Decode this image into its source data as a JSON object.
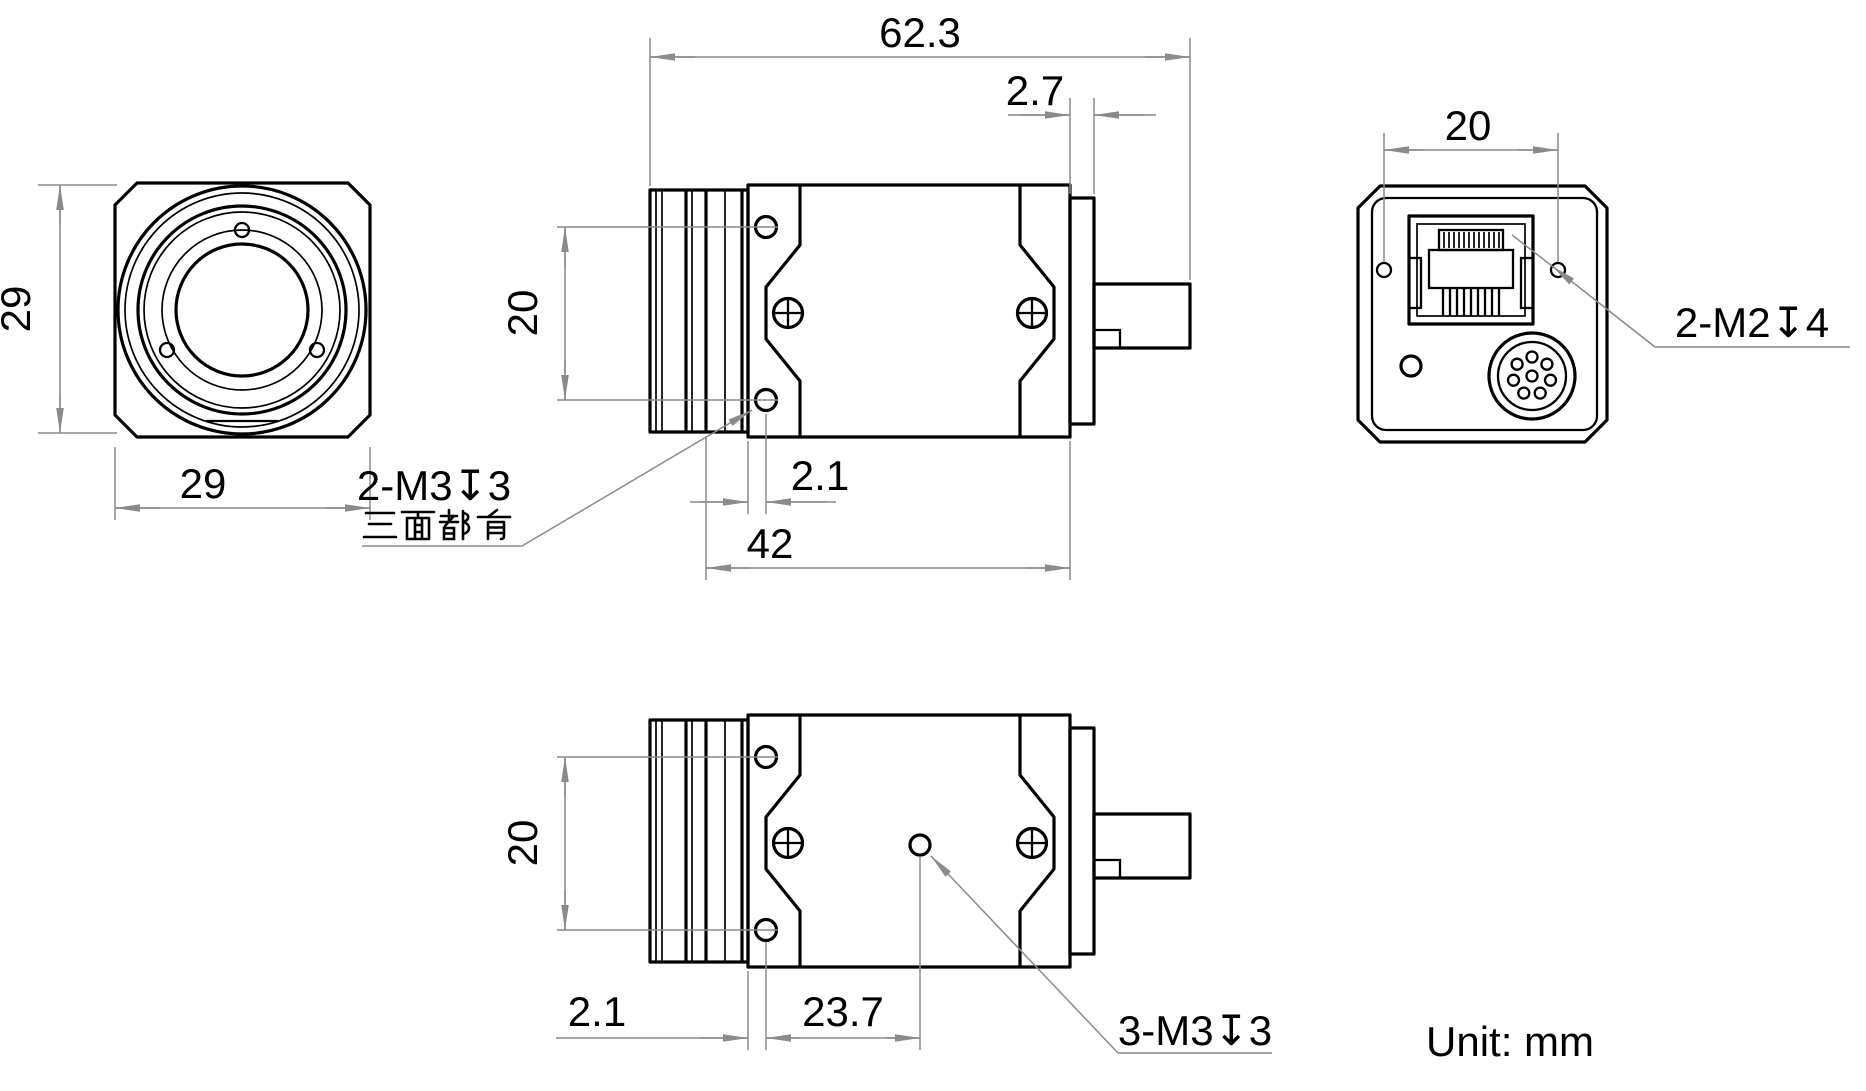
{
  "dims": {
    "front_width": "29",
    "front_height": "29",
    "total_length": "62.3",
    "rear_step": "2.7",
    "side_hole_spacing": "20",
    "side_hole_offset": "2.1",
    "body_length": "42",
    "back_hole_spacing": "20",
    "bottom_hole_spacing": "20",
    "bottom_hole_offset": "2.1",
    "bottom_center_offset": "23.7"
  },
  "notes": {
    "side_thread": "2-M3↧3",
    "side_thread_cn": "三面都有",
    "back_thread": "2-M2↧4",
    "bottom_thread": "3-M3↧3",
    "unit": "Unit: mm"
  },
  "colors": {
    "line": "#000000",
    "dimension": "#8a8a8a"
  }
}
